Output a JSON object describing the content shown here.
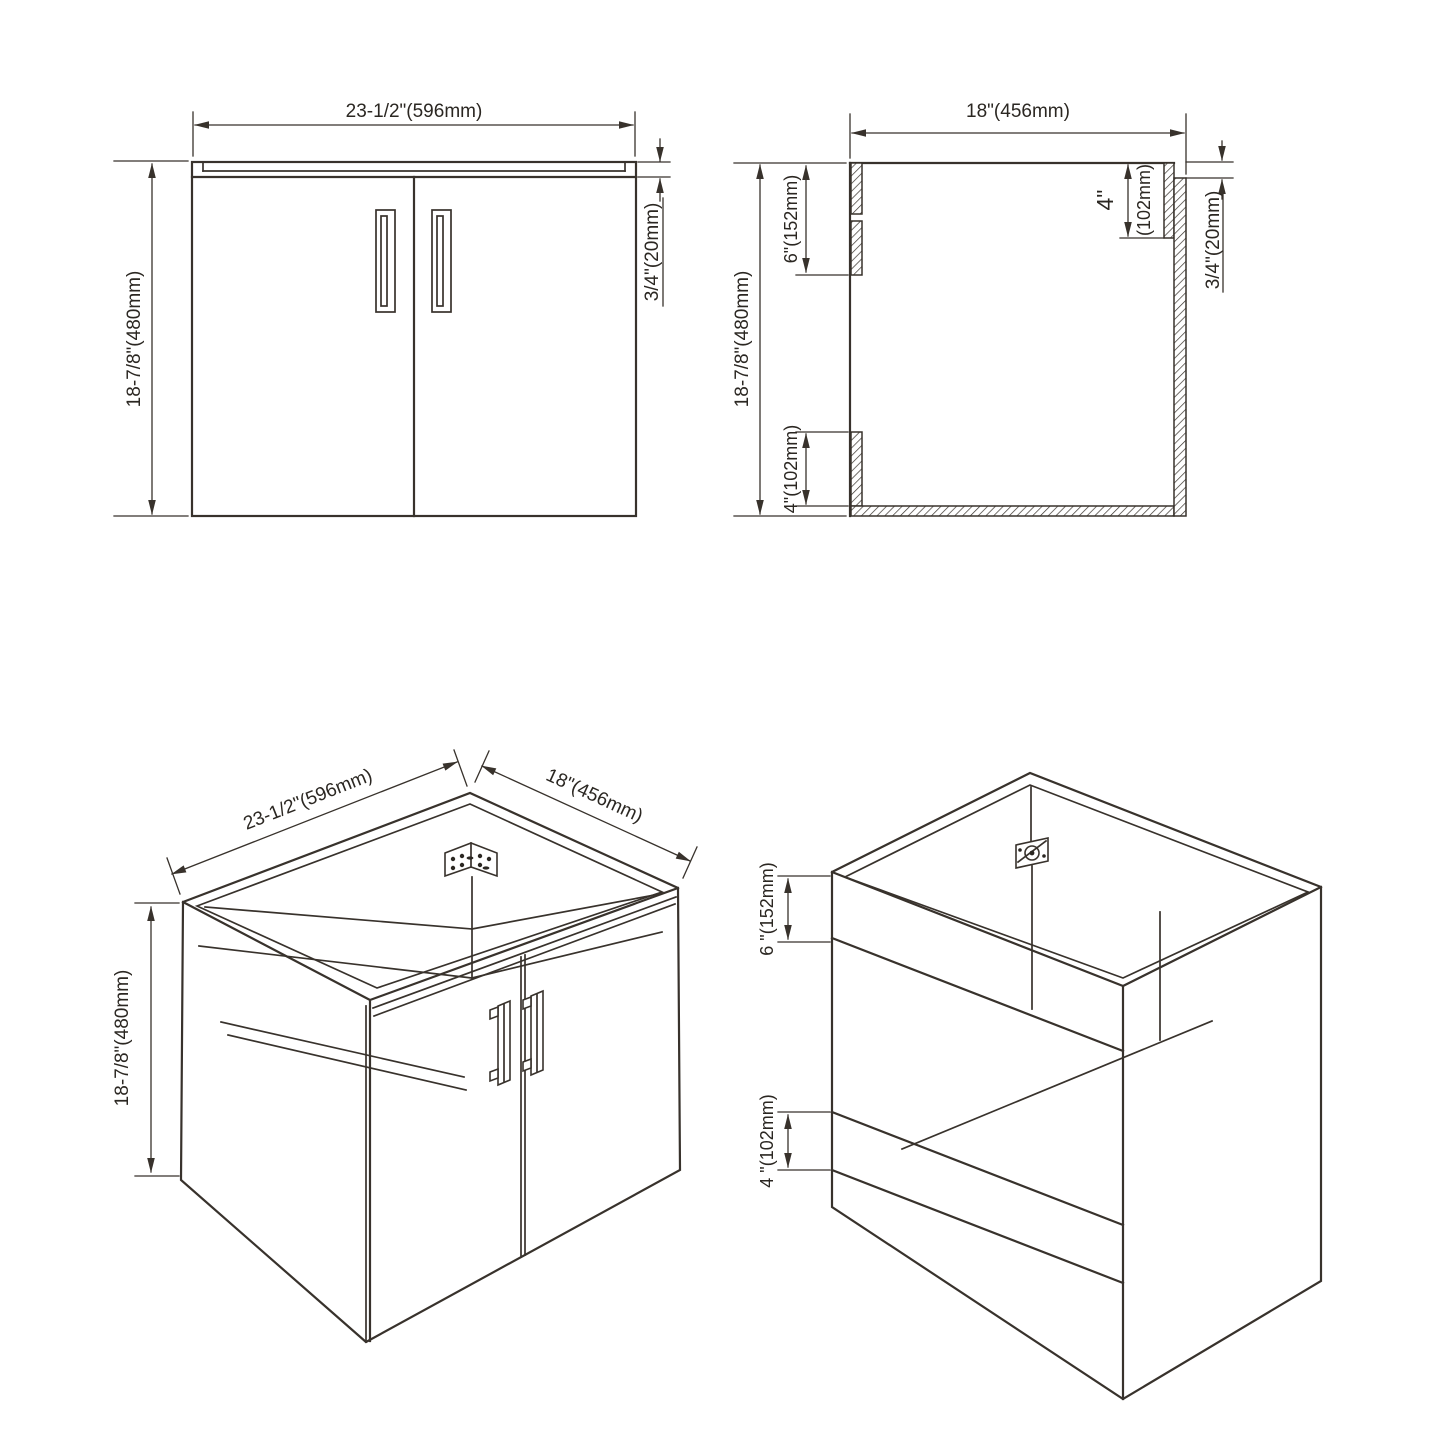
{
  "document": {
    "type": "cabinet-technical-drawing",
    "background_color": "#ffffff",
    "line_color": "#38322c",
    "text_color": "#2b2722"
  },
  "views": {
    "front_elevation": {
      "width": "23-1/2\"(596mm)",
      "height": "18-7/8\"(480mm)",
      "counter_thickness": "3/4\"(20mm)"
    },
    "side_section": {
      "depth": "18\"(456mm)",
      "height": "18-7/8\"(480mm)",
      "front_top_rail": "6\"(152mm)",
      "front_bottom_rail": "4\"(102mm)",
      "back_rail_inches": "4\"",
      "back_rail_mm": "(102mm)",
      "panel_thickness": "3/4\"(20mm)"
    },
    "isometric_front": {
      "width": "23-1/2\"(596mm)",
      "depth": "18\"(456mm)",
      "height": "18-7/8\"(480mm)"
    },
    "isometric_back": {
      "top_rail": "6 \"(152mm)",
      "bottom_rail": "4 \"(102mm)"
    }
  }
}
